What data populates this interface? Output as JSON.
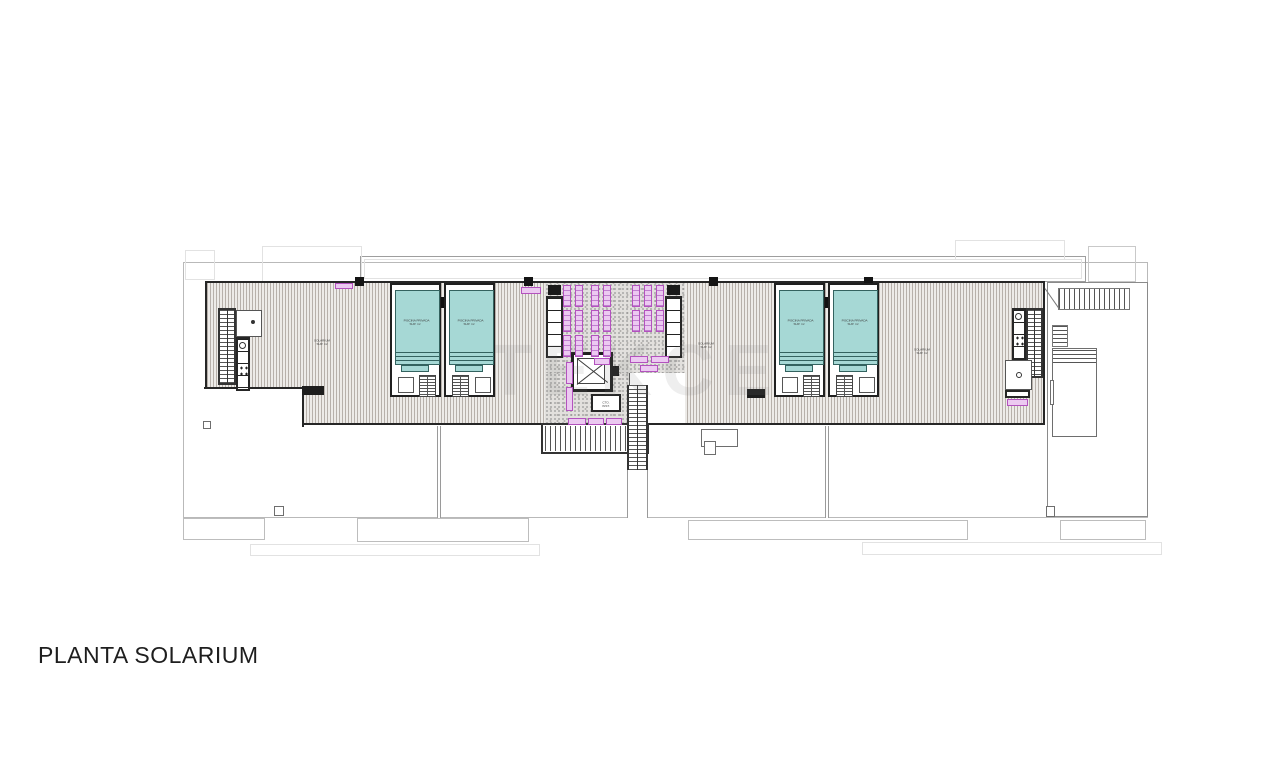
{
  "title": {
    "label": "PLANTA SOLARIUM"
  },
  "watermark": {
    "text": "TEKCE"
  },
  "colors": {
    "pool_water": "#a6d8d5",
    "lounger_fill": "#ecc9f1",
    "lounger_stroke": "#b352be",
    "deck_stripe": "#8a8078",
    "outline_dark": "#262626",
    "outline_gray": "#bdbdbd"
  },
  "labels": {
    "solarium": {
      "line1": "SOLARIUM",
      "line2": "SUP. m²"
    },
    "pool": {
      "line1": "PISCINA PRIVADA",
      "line2": "SUP. m²"
    },
    "machine": {
      "line1": "CTO.",
      "line2": "INST."
    }
  },
  "plan": {
    "solarium_labels": [
      {
        "x": 322,
        "y": 333
      },
      {
        "x": 706,
        "y": 336
      },
      {
        "x": 922,
        "y": 342
      }
    ],
    "pools": [
      {
        "x": 390,
        "mirror": false
      },
      {
        "x": 444,
        "mirror": true
      },
      {
        "x": 774,
        "mirror": false
      },
      {
        "x": 828,
        "mirror": true
      }
    ],
    "loungers": [
      {
        "x": 563,
        "y": 285
      },
      {
        "x": 575,
        "y": 285
      },
      {
        "x": 591,
        "y": 285
      },
      {
        "x": 603,
        "y": 285
      },
      {
        "x": 632,
        "y": 285
      },
      {
        "x": 644,
        "y": 285
      },
      {
        "x": 656,
        "y": 285
      },
      {
        "x": 563,
        "y": 310
      },
      {
        "x": 575,
        "y": 310
      },
      {
        "x": 591,
        "y": 310
      },
      {
        "x": 603,
        "y": 310
      },
      {
        "x": 632,
        "y": 310
      },
      {
        "x": 644,
        "y": 310
      },
      {
        "x": 656,
        "y": 310
      },
      {
        "x": 563,
        "y": 335
      },
      {
        "x": 575,
        "y": 335
      },
      {
        "x": 591,
        "y": 335
      },
      {
        "x": 603,
        "y": 335
      }
    ],
    "pink_items": [
      {
        "x": 335,
        "y": 283,
        "w": 18,
        "h": 6
      },
      {
        "x": 521,
        "y": 287,
        "w": 20,
        "h": 7
      },
      {
        "x": 630,
        "y": 356,
        "w": 18,
        "h": 7
      },
      {
        "x": 651,
        "y": 356,
        "w": 18,
        "h": 7
      },
      {
        "x": 640,
        "y": 365,
        "w": 18,
        "h": 7
      },
      {
        "x": 594,
        "y": 358,
        "w": 16,
        "h": 7
      },
      {
        "x": 566,
        "y": 362,
        "w": 7,
        "h": 22
      },
      {
        "x": 566,
        "y": 387,
        "w": 7,
        "h": 24
      },
      {
        "x": 568,
        "y": 418,
        "w": 18,
        "h": 7
      },
      {
        "x": 588,
        "y": 418,
        "w": 16,
        "h": 7
      },
      {
        "x": 606,
        "y": 418,
        "w": 16,
        "h": 7
      },
      {
        "x": 1007,
        "y": 399,
        "w": 21,
        "h": 7
      }
    ],
    "ticks": [
      {
        "x": 355,
        "y": 277
      },
      {
        "x": 524,
        "y": 277
      },
      {
        "x": 709,
        "y": 277
      },
      {
        "x": 864,
        "y": 277
      }
    ],
    "chimneys": [
      {
        "x": 203,
        "y": 421,
        "w": 8,
        "h": 8
      },
      {
        "x": 274,
        "y": 506,
        "w": 10,
        "h": 10
      },
      {
        "x": 701,
        "y": 429,
        "w": 37,
        "h": 18
      },
      {
        "x": 704,
        "y": 441,
        "w": 12,
        "h": 14
      },
      {
        "x": 1046,
        "y": 506,
        "w": 9,
        "h": 11
      }
    ],
    "dividers": [
      {
        "x": 437,
        "y": 426,
        "h": 92
      },
      {
        "x": 825,
        "y": 426,
        "h": 92
      }
    ]
  }
}
